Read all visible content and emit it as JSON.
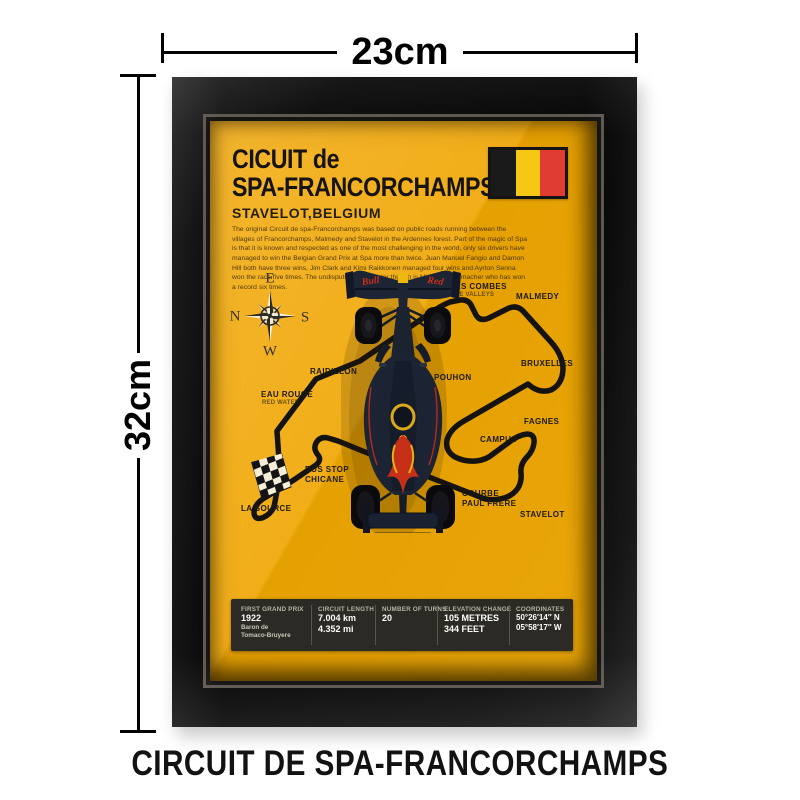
{
  "dimensions": {
    "width_label": "23cm",
    "height_label": "32cm"
  },
  "caption": "CIRCUIT DE SPA-FRANCORCHAMPS",
  "poster": {
    "title_line1": "CICUIT de",
    "title_line2": "SPA-FRANCORCHAMPS",
    "subtitle": "STAVELOT,BELGIUM",
    "description": "The original Circuit de spa-Francorchamps was based on public roads running between the villages of Francorchamps, Malmedy and Stavelot in the Ardennes forest. Part of the magic of Spa is that it is known and respected as one of the most challenging in the world, only six drivers have managed to win the Belgian Grand Prix at Spa more than twice. Juan Manuel Fangio and Damon Hill both have three wins, Jim Clark and Kimi Raikkonen managed four wins and Ayrton Senna won the race five times. The undisputed Spa master though is Michael Schumacher who has won a record six times.",
    "flag_colors": [
      "#1a1a1a",
      "#f5c913",
      "#e03c31"
    ],
    "compass": {
      "top": "E",
      "left": "N",
      "right": "S",
      "bottom": "W"
    },
    "track_labels": {
      "les_combes": "LES COMBES",
      "les_combes_sub": "THE VALLEYS",
      "malmedy": "MALMEDY",
      "bruxelles": "BRUXELLES",
      "pouhon": "POUHON",
      "fagnes": "FAGNES",
      "campus": "CAMPUS",
      "blanchimont": "BLANCHIMONT",
      "raidillon": "RAIDILLON",
      "eau_rouge": "EAU ROUGE",
      "eau_rouge_sub": "RED WATER",
      "bus_stop_1": "BUS STOP",
      "bus_stop_2": "CHICANE",
      "la_source": "LA SOURCE",
      "courbe_1": "COURBE",
      "courbe_2": "PAUL FRERE",
      "stavelot": "STAVELOT"
    },
    "car": {
      "wing_left": "Bull",
      "wing_right": "Red",
      "rear_plate": "BYBIT"
    },
    "stats": {
      "c1": {
        "label": "FIRST GRAND PRIX",
        "big": "1922",
        "sub1": "Baron de",
        "sub2": "Tomaco-Bruyere"
      },
      "c2": {
        "label": "CIRCUIT LENGTH",
        "big": "7.004 km",
        "big2": "4.352 mi"
      },
      "c3": {
        "label": "NUMBER OF TURNS",
        "big": "20"
      },
      "c4": {
        "label": "ELEVATION CHANGE",
        "big": "105 METRES",
        "big2": "344 FEET"
      },
      "c5": {
        "label": "COORDINATES",
        "big": "50°26′14″ N",
        "big2": "05°58′17″ W"
      }
    },
    "colors": {
      "poster_light": "#f3b12a",
      "poster_dark": "#e8a405",
      "frame": "#0c0c0c",
      "track_line": "#151310",
      "stats_bar_bg": "#2b2a25",
      "accent_red": "#c93018",
      "accent_yellow": "#e8b012"
    }
  }
}
